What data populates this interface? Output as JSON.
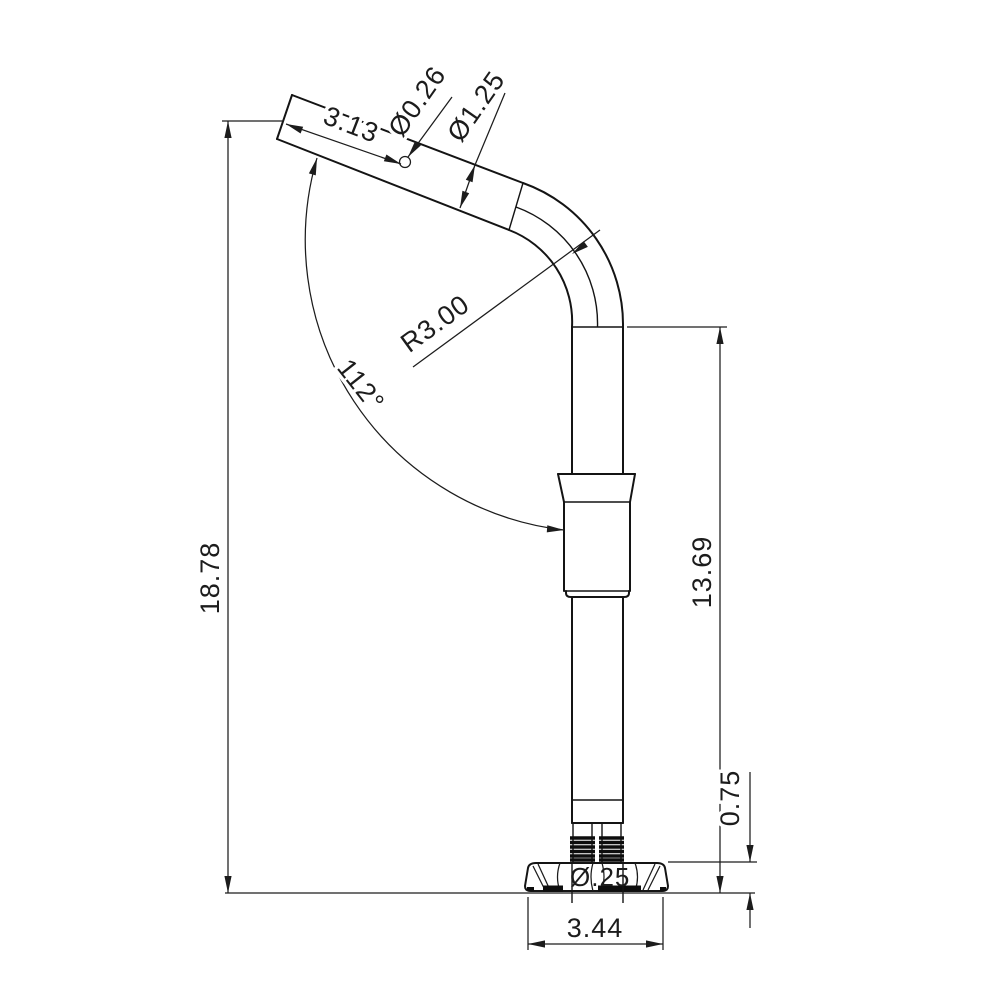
{
  "drawing": {
    "type": "technical-dimension-drawing",
    "part": "bent tube post with collar and threaded flange base",
    "background_color": "#ffffff",
    "line_color": "#141414",
    "dimensions": {
      "tip_length": "3.13",
      "hole_diameter": "Ø0.26",
      "tube_diameter": "Ø1.25",
      "bend_radius": "R3.00",
      "bend_angle": "112°",
      "overall_height": "18.78",
      "post_height": "13.69",
      "flange_thickness": "0.75",
      "base_width": "3.44",
      "thread_callout": "Ø.25"
    }
  }
}
